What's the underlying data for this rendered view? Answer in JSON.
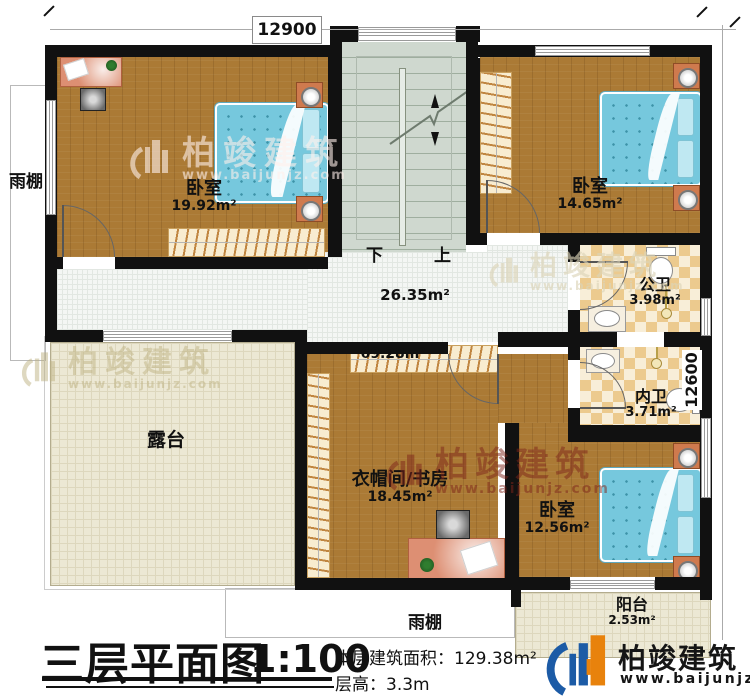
{
  "dimensions": {
    "top": "12900",
    "right": "12600"
  },
  "stairs": {
    "down": "下",
    "up": "上"
  },
  "rooms": {
    "bedroom_tl": {
      "name": "卧室",
      "area": "19.92m²"
    },
    "bedroom_tr": {
      "name": "卧室",
      "area": "14.65m²"
    },
    "bedroom_br": {
      "name": "卧室",
      "area": "12.56m²"
    },
    "public_bath": {
      "name": "公卫",
      "area": "3.98m²"
    },
    "ensuite_bath": {
      "name": "内卫",
      "area": "3.71m²"
    },
    "cloak_study": {
      "name": "衣帽间/书房",
      "area": "18.45m²"
    },
    "hallway": {
      "area": "26.35m²"
    },
    "upper_area": {
      "area": "69.28m²"
    },
    "terrace": {
      "name": "露台"
    },
    "canopy_left": {
      "name": "雨棚"
    },
    "canopy_bottom": {
      "name": "雨棚"
    },
    "balcony": {
      "name": "阳台",
      "area": "2.53m²"
    }
  },
  "title_block": {
    "title": "三层平面图",
    "scale": "1:100",
    "area_label": "本层建筑面积：",
    "area_value": "129.38m²",
    "height_label": "层高：",
    "height_value": "3.3m"
  },
  "brand": {
    "name": "柏竣建筑",
    "url": "www.baijunjz.com"
  },
  "colors": {
    "wall": "#111111",
    "wood": "#ab7a35",
    "stairs": "#cfd8cf",
    "bath_tile": "#ecca8e",
    "terrace": "#ece8d4",
    "bed": "#76c8dd",
    "logo_blue": "#1c5ba6",
    "logo_orange": "#e8820c",
    "watermark_red": "#7d2319"
  }
}
